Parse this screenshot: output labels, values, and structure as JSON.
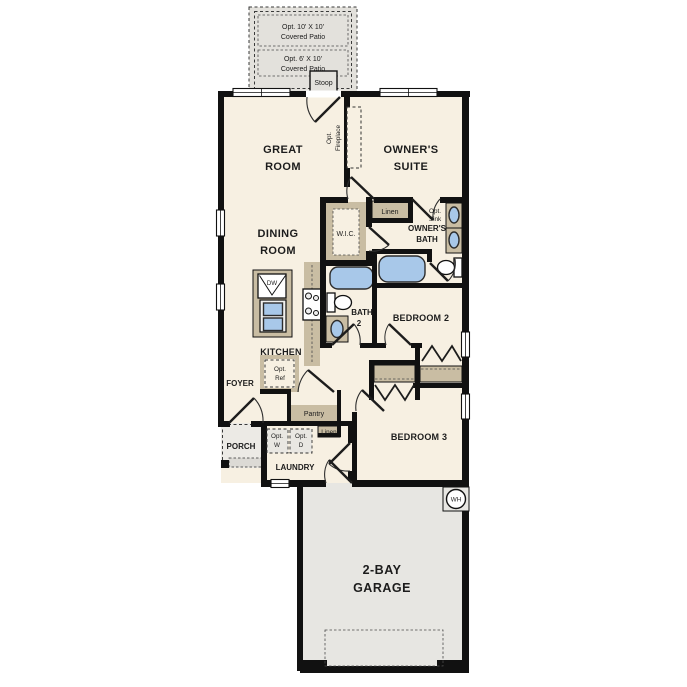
{
  "colors": {
    "floor": "#f7f0e2",
    "wall": "#111111",
    "counter_tan": "#c9bda3",
    "fixture_blue": "#a8c8e9",
    "garage_floor": "#e7e6e2",
    "patio_gray": "#e3e1dc",
    "porch_gray": "#eceae5"
  },
  "labels": {
    "patio10_l1": "Opt. 10' X 10'",
    "patio10_l2": "Covered Patio",
    "patio6_l1": "Opt. 6' X 10'",
    "patio6_l2": "Covered Patio",
    "stoop": "Stoop",
    "great_l1": "GREAT",
    "great_l2": "ROOM",
    "suite_l1": "OWNER'S",
    "suite_l2": "SUITE",
    "fireplace_l1": "Opt.",
    "fireplace_l2": "Fireplace",
    "dining_l1": "DINING",
    "dining_l2": "ROOM",
    "wic": "W.I.C.",
    "linen1": "Linen",
    "obath_l1": "OWNER'S",
    "obath_l2": "BATH",
    "optsink_l1": "Opt.",
    "optsink_l2": "Sink",
    "bath2_l1": "BATH",
    "bath2_l2": "2",
    "bedroom2": "BEDROOM 2",
    "bedroom3": "BEDROOM 3",
    "kitchen": "KITCHEN",
    "dw": "DW",
    "dining_foyer": "FOYER",
    "optref_l1": "Opt.",
    "optref_l2": "Ref",
    "pantry": "Pantry",
    "linen2": "Linen",
    "porch": "PORCH",
    "optw_l1": "Opt.",
    "optw_l2": "W",
    "optd_l1": "Opt.",
    "optd_l2": "D",
    "laundry": "LAUNDRY",
    "garage_l1": "2-BAY",
    "garage_l2": "GARAGE",
    "wh": "WH"
  }
}
